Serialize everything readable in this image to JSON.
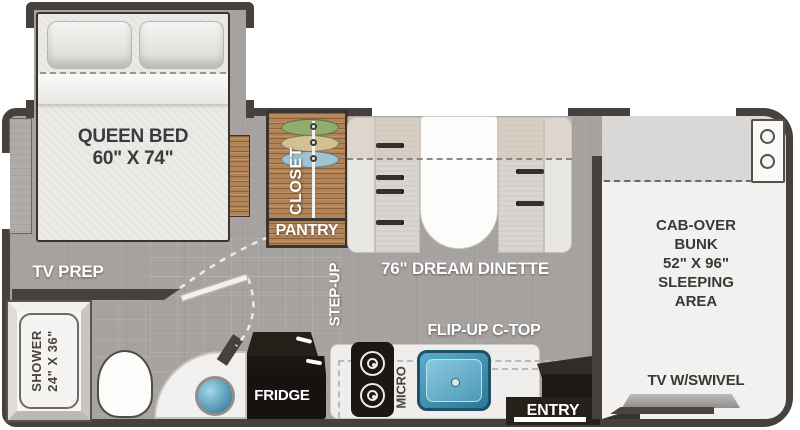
{
  "floorplan": {
    "bedroom": {
      "bed": "QUEEN BED",
      "bed_size": "60\" X 74\"",
      "tv_prep": "TV PREP"
    },
    "wardrobe": {
      "closet": "CLOSET",
      "pantry": "PANTRY"
    },
    "hallway": {
      "step_up": "STEP-UP"
    },
    "dinette": {
      "name": "76\" DREAM DINETTE"
    },
    "kitchen": {
      "flip_up_countertop": "FLIP-UP C-TOP",
      "microwave": "MICRO",
      "fridge": "FRIDGE"
    },
    "entry": {
      "name": "ENTRY"
    },
    "bunk": {
      "line1": "CAB-OVER",
      "line2": "BUNK",
      "line3": "52\" X 96\"",
      "line4": "SLEEPING",
      "line5": "AREA",
      "tv": "TV W/SWIVEL"
    },
    "bathroom": {
      "shower": "SHOWER",
      "shower_size": "24\" X 36\""
    },
    "colors": {
      "wall": "#47413d",
      "floor_gray": "#a5a2a0",
      "closet_wood": "#b28356",
      "hanger_green": "#8fae6e",
      "hanger_tan": "#d4c193",
      "hanger_blue": "#9ec3d3",
      "sink_blue": "#4f9ab8",
      "fridge_black": "#171310",
      "bunk_white": "#f2f1ef"
    }
  }
}
